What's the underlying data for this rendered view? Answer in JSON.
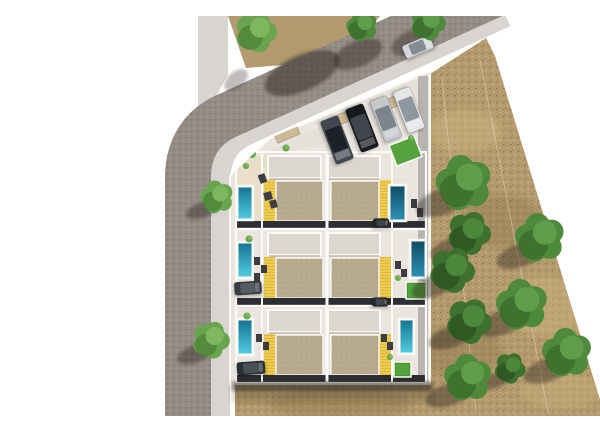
{
  "scene": {
    "description": "Aerial top-down 3D render of a residential development site plan: an L-shaped street on the top and left, a walled compound containing three rows of semi-detached villas (6 units) with roof terraces, yellow slatted awnings, private swimming pools, lawns and carports, a guest parking row with four cars along the angled street edge, and a dry grass field with scattered green trees on the right side.",
    "objects": {
      "house_rows": 3,
      "houses": 6,
      "pools": 6,
      "lawns": 3,
      "cars": 9,
      "trees": 14,
      "streets": 2
    },
    "palette": {
      "page_bg": "#ffffff",
      "road": "#948d85",
      "sidewalk": "#d8d5d0",
      "field": "#b49a6c",
      "field_light": "#cdb583",
      "field_dark": "#87744c",
      "dirt": "#b29a6e",
      "pavement": "#eae6df",
      "pavement_warm": "#e8dcc2",
      "driveway": "#e0dbd2",
      "shade_strip": "#4a4b50",
      "wall": "#fbfaf7",
      "slab": "#dcd7ce",
      "slab_shadow": "#a89f92",
      "roof": "#b7aa8e",
      "awning": "#eccb4f",
      "awning_line": "#c79f2e",
      "dark_band": "#2d2e33",
      "lawn": "#54a33d",
      "lawn_dark": "#3d8a2c",
      "pool_a_top": "#13718f",
      "pool_a_bottom": "#53cfe2",
      "pool_b_top": "#0e4a62",
      "pool_b_bottom": "#2e93b4",
      "tree_light": "#68a54e",
      "tree_light2": "#7fba60",
      "tree_light_dark": "#4c8438",
      "tree_mid": "#4f8a3c",
      "tree_mid2": "#63a04b",
      "tree_mid_dark": "#3a6c2a",
      "tree_dark": "#3e7030",
      "tree_dark2": "#4f8a3e",
      "tree_dark_dark": "#2c5420",
      "shadow": "#2e2820",
      "canopy": "#cdbb97",
      "furniture": "#3c3d42",
      "fence_line": "rgba(240,233,214,0.4)",
      "tex_road_dark": "rgba(60,56,52,0.30)",
      "tex_road_light": "rgba(226,223,219,0.20)",
      "tex_field_dark": "rgba(96,78,44,0.50)",
      "tex_field_light": "rgba(235,214,160,0.45)",
      "tex_roof": "rgba(116,102,78,0.20)",
      "tex_pave": "rgba(150,140,124,0.18)"
    },
    "ground": {
      "field_points": "390,58 446,22 455,40 565,400 195,400 195,368 390,368",
      "dirt_top_points": "188,0 340,0 301,44 206,52",
      "sidewalk_top_points": "158,0 188,0 188,58 168,96 158,96",
      "sidewalk_path": "M 170,410 L 170,162 Q 172,124 203,110 L 462,-8",
      "sidewalk_width": 40,
      "road_path": "M 148,410 L 148,158 Q 150,118 184,101 L 455,-22",
      "road_width": 46,
      "compound_points": "190,368 190,160 230,122 388,56 390,56 390,368",
      "driveway_points": "196,152 378,64 384,96 240,140 218,156",
      "patio_row1": {
        "x": 194,
        "y": 140,
        "w": 44,
        "h": 66
      },
      "shade_strip": {
        "x": 378,
        "y": 60,
        "w": 10,
        "h": 306
      },
      "fence_lines": [
        "402,62 436,396",
        "440,44 508,396"
      ]
    },
    "field_patches": [
      {
        "cx": 425,
        "cy": 115,
        "rx": 38,
        "ry": 22,
        "tone": "light",
        "o": 0.5
      },
      {
        "cx": 505,
        "cy": 290,
        "rx": 48,
        "ry": 30,
        "tone": "light",
        "o": 0.45
      },
      {
        "cx": 462,
        "cy": 205,
        "rx": 40,
        "ry": 26,
        "tone": "dark",
        "o": 0.35
      },
      {
        "cx": 420,
        "cy": 335,
        "rx": 42,
        "ry": 26,
        "tone": "dark",
        "o": 0.35
      },
      {
        "cx": 300,
        "cy": 388,
        "rx": 70,
        "ry": 18,
        "tone": "dark",
        "o": 0.3
      },
      {
        "cx": 520,
        "cy": 375,
        "rx": 40,
        "ry": 18,
        "tone": "light",
        "o": 0.4
      }
    ],
    "road_shadows": [
      {
        "cx": 262,
        "cy": 57,
        "rx": 40,
        "ry": 18,
        "rot": -24,
        "o": 0.5
      },
      {
        "cx": 318,
        "cy": 38,
        "rx": 26,
        "ry": 13,
        "rot": -24,
        "o": 0.45
      },
      {
        "cx": 373,
        "cy": 26,
        "rx": 23,
        "ry": 12,
        "rot": -24,
        "o": 0.4
      },
      {
        "cx": 196,
        "cy": 64,
        "rx": 14,
        "ry": 8,
        "rot": -40,
        "o": 0.3
      }
    ],
    "row_geometry": {
      "x": 196,
      "w": 190,
      "h": 77,
      "slabs": [
        {
          "x": 228,
          "w": 53
        },
        {
          "x": 288,
          "w": 52
        }
      ],
      "slab_dy": 4,
      "slab_h": 22,
      "roofs": [
        {
          "x": 236,
          "w": 47
        },
        {
          "x": 291,
          "w": 48
        }
      ],
      "roof_dy": 29,
      "roof_h": 40,
      "awnings": [
        {
          "x": 224,
          "w": 12
        },
        {
          "x": 339,
          "w": 12
        }
      ],
      "awn_dy": 28,
      "awn_h": 43,
      "band_dy": 69,
      "band_h": 8,
      "dividers": [
        222,
        287,
        352
      ]
    },
    "rows": [
      {
        "y": 136,
        "pool_left": {
          "x": 197,
          "y": 170,
          "w": 16,
          "h": 34,
          "g": "A"
        },
        "pool_right": {
          "x": 349,
          "y": 169,
          "w": 17,
          "h": 36,
          "g": "B"
        },
        "lawn": null
      },
      {
        "y": 213,
        "pool_left": {
          "x": 197,
          "y": 226,
          "w": 16,
          "h": 36,
          "g": "A"
        },
        "pool_right": {
          "x": 370,
          "y": 224,
          "w": 16,
          "h": 38,
          "g": "B"
        },
        "lawn": {
          "x": 366,
          "y": 266,
          "w": 20,
          "h": 17
        }
      },
      {
        "y": 290,
        "pool_left": {
          "x": 197,
          "y": 303,
          "w": 16,
          "h": 36,
          "g": "A"
        },
        "pool_right": {
          "x": 359,
          "y": 303,
          "w": 15,
          "h": 35,
          "g": "A"
        },
        "lawn": {
          "x": 354,
          "y": 346,
          "w": 17,
          "h": 15
        }
      }
    ],
    "lawn_top": {
      "x": 352,
      "y": 124,
      "w": 27,
      "h": 22,
      "rot": -21
    },
    "canopies": [
      {
        "cx": 182,
        "cy": 151,
        "l": 26,
        "w": 9,
        "rot": -35
      },
      {
        "cx": 247,
        "cy": 118,
        "l": 24,
        "w": 10,
        "rot": -23
      },
      {
        "cx": 308,
        "cy": 100,
        "l": 24,
        "w": 10,
        "rot": -23
      },
      {
        "cx": 349,
        "cy": 88,
        "l": 26,
        "w": 10,
        "rot": -23
      }
    ],
    "cars": [
      {
        "name": "car-road-silver",
        "cx": 378,
        "cy": 31,
        "len": 30,
        "wid": 14,
        "angle": -23,
        "body": "#d4d6d9",
        "glass": "#848b94"
      },
      {
        "name": "car-parking-darkgray",
        "cx": 297,
        "cy": 124,
        "len": 46,
        "wid": 19,
        "angle": 69,
        "body": "#42464e",
        "glass": "#1d2026"
      },
      {
        "name": "car-parking-black",
        "cx": 322,
        "cy": 112,
        "len": 46,
        "wid": 19,
        "angle": 69,
        "body": "#17181c",
        "glass": "#40454e"
      },
      {
        "name": "car-parking-silver",
        "cx": 346,
        "cy": 103,
        "len": 44,
        "wid": 18,
        "angle": 69,
        "body": "#c6c8cc",
        "glass": "#7d848d"
      },
      {
        "name": "car-parking-white",
        "cx": 369,
        "cy": 94,
        "len": 44,
        "wid": 18,
        "angle": 69,
        "body": "#e4e5e7",
        "glass": "#8f97a0"
      },
      {
        "name": "car-carport-left-upper",
        "cx": 208,
        "cy": 272,
        "len": 27,
        "wid": 13,
        "angle": -4,
        "body": "#383b42",
        "glass": "#555c65"
      },
      {
        "name": "car-carport-left-lower",
        "cx": 211,
        "cy": 352,
        "len": 28,
        "wid": 13,
        "angle": -4,
        "body": "#2b2e34",
        "glass": "#495058"
      },
      {
        "name": "car-carport-right-upper",
        "cx": 341,
        "cy": 207,
        "len": 16,
        "wid": 9,
        "angle": 0,
        "body": "#232529",
        "glass": "#3d424a"
      },
      {
        "name": "car-carport-right-lower",
        "cx": 340,
        "cy": 286,
        "len": 16,
        "wid": 9,
        "angle": 0,
        "body": "#26282c",
        "glass": "#42474f"
      }
    ],
    "furniture": [
      {
        "x": 219,
        "y": 158,
        "w": 7,
        "h": 9,
        "rot": -20
      },
      {
        "x": 224,
        "y": 176,
        "w": 8,
        "h": 8,
        "rot": -15
      },
      {
        "x": 230,
        "y": 184,
        "w": 7,
        "h": 8,
        "rot": -15
      },
      {
        "x": 214,
        "y": 241,
        "w": 6,
        "h": 8,
        "rot": 0
      },
      {
        "x": 221,
        "y": 249,
        "w": 6,
        "h": 8,
        "rot": 0
      },
      {
        "x": 214,
        "y": 257,
        "w": 6,
        "h": 8,
        "rot": 0
      },
      {
        "x": 216,
        "y": 318,
        "w": 6,
        "h": 8,
        "rot": 0
      },
      {
        "x": 223,
        "y": 326,
        "w": 6,
        "h": 8,
        "rot": 0
      },
      {
        "x": 371,
        "y": 183,
        "w": 6,
        "h": 9,
        "rot": 0
      },
      {
        "x": 377,
        "y": 192,
        "w": 6,
        "h": 9,
        "rot": 0
      },
      {
        "x": 355,
        "y": 245,
        "w": 6,
        "h": 8,
        "rot": 0
      },
      {
        "x": 361,
        "y": 253,
        "w": 6,
        "h": 8,
        "rot": 0
      },
      {
        "x": 341,
        "y": 318,
        "w": 6,
        "h": 8,
        "rot": 0
      },
      {
        "x": 347,
        "y": 326,
        "w": 6,
        "h": 8,
        "rot": 0
      }
    ],
    "shrubs": [
      {
        "x": 212,
        "y": 138,
        "r": 4
      },
      {
        "x": 246,
        "y": 132,
        "r": 3.5
      },
      {
        "x": 206,
        "y": 150,
        "r": 3
      },
      {
        "x": 209,
        "y": 223,
        "r": 3.5
      },
      {
        "x": 207,
        "y": 300,
        "r": 3.5
      },
      {
        "x": 358,
        "y": 262,
        "r": 3
      },
      {
        "x": 350,
        "y": 341,
        "r": 3
      },
      {
        "x": 371,
        "y": 122,
        "r": 3
      }
    ],
    "building_shadow": [
      {
        "x": 192,
        "y": 366,
        "w": 200,
        "h": 9,
        "o": 0.5,
        "f": "soft"
      },
      {
        "x": 192,
        "y": 366,
        "w": 202,
        "h": 20,
        "o": 0.22,
        "f": "softer"
      }
    ],
    "trees": [
      {
        "x": 216,
        "y": 16,
        "r": 20,
        "tone": "light",
        "sh": false
      },
      {
        "x": 322,
        "y": 10,
        "r": 15,
        "tone": "mid",
        "sh": false
      },
      {
        "x": 388,
        "y": 7,
        "r": 17,
        "tone": "mid",
        "sh": false
      },
      {
        "x": 177,
        "y": 181,
        "r": 16,
        "tone": "light",
        "sh": true
      },
      {
        "x": 171,
        "y": 324,
        "r": 18,
        "tone": "light",
        "sh": true
      },
      {
        "x": 424,
        "y": 167,
        "r": 27,
        "tone": "mid",
        "sh": true
      },
      {
        "x": 429,
        "y": 217,
        "r": 21,
        "tone": "dark",
        "sh": true
      },
      {
        "x": 500,
        "y": 222,
        "r": 24,
        "tone": "mid",
        "sh": true
      },
      {
        "x": 412,
        "y": 254,
        "r": 22,
        "tone": "dark",
        "sh": true
      },
      {
        "x": 482,
        "y": 289,
        "r": 25,
        "tone": "mid",
        "sh": true
      },
      {
        "x": 429,
        "y": 305,
        "r": 22,
        "tone": "dark",
        "sh": true
      },
      {
        "x": 527,
        "y": 337,
        "r": 24,
        "tone": "mid",
        "sh": true
      },
      {
        "x": 470,
        "y": 352,
        "r": 15,
        "tone": "dark",
        "sh": true
      },
      {
        "x": 428,
        "y": 362,
        "r": 23,
        "tone": "mid",
        "sh": true
      }
    ]
  }
}
